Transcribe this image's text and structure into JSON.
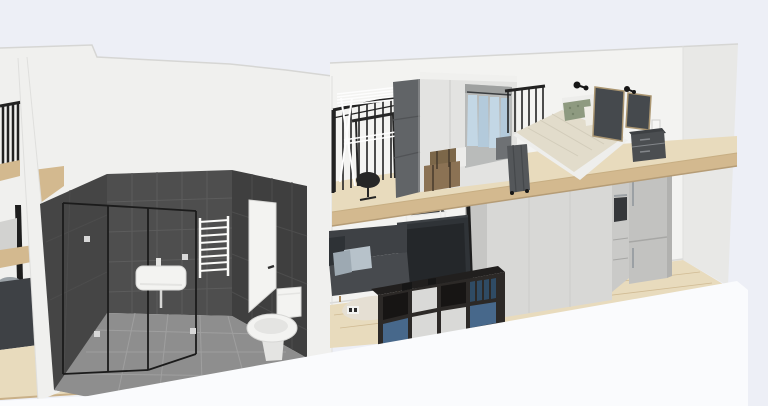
{
  "app": {
    "name": "3d-home-design-viewport",
    "view_mode": "3d-perspective-cutaway",
    "visible_text": ""
  },
  "scene": {
    "units": [
      {
        "name": "neighbor-unit-sliver",
        "objects": [
          "mezzanine-railing",
          "floor-slab",
          "support-post",
          "cabinet",
          "gray-chair",
          "dark-sofa",
          "wood-floor"
        ]
      },
      {
        "name": "main-unit",
        "rooms": [
          {
            "name": "bathroom",
            "objects": [
              "dark-tile-walls",
              "tile-floor",
              "glass-shower-enclosure",
              "wall-mounted-sink",
              "towel-radiator",
              "interior-door",
              "toilet"
            ]
          },
          {
            "name": "living-area",
            "objects": [
              "sofa",
              "throw-pillows",
              "tv",
              "white-side-table",
              "cube-storage-shelf",
              "storage-boxes",
              "round-rug",
              "wall-outlet",
              "three-door-wardrobe",
              "oven-column",
              "fridge-freezer",
              "support-post",
              "wood-floor"
            ]
          },
          {
            "name": "mezzanine-bedroom",
            "objects": [
              "black-railing",
              "drying-rack",
              "desk",
              "office-chair",
              "wardrobe-open-door",
              "open-wardrobe-hanging-clothes",
              "brown-storage-boxes",
              "white-stool",
              "suitcase",
              "double-bed",
              "green-pillow",
              "white-pillow",
              "wall-art-frames",
              "wall-lamps",
              "nightstand",
              "light-switch",
              "railing-segment"
            ]
          }
        ]
      }
    ]
  },
  "colors": {
    "background": "#edeff6",
    "exteriorWall": "#f0f0ee",
    "wallFace": "#f3f3f1",
    "wallShade": "#e8e8e6",
    "wallCapLine": "#d6d6d4",
    "edgeLine": "#dfdfdd",
    "baseboard": "#dadad8",
    "tileWest": "#454545",
    "tileBack": "#4e4e4e",
    "tileRight": "#3f3f3f",
    "groutDark": "#5c5c5c",
    "groutRight": "#4d4d4d",
    "tileFloor": "#8e8e8e",
    "groutFloor": "#a2a2a2",
    "showerFrame": "#1b1b1b",
    "glassHandle": "#d8d8d8",
    "fixtureWhite": "#f3f3f1",
    "fixtureStroke": "#d7d7d5",
    "fixtureShade": "#e4e4e2",
    "doorHandle": "#2f2f2f",
    "radiatorWhite": "#fbfbf9",
    "wood": "#e8dbbd",
    "woodFascia": "#d3b98f",
    "woodLine": "#c7ae83",
    "woodShadow": "#b59c76",
    "railBlack": "#222222",
    "rackWhite": "#fdfdfd",
    "deskBlack": "#262626",
    "doorOpenGray": "#616467",
    "doorSeam": "#515356",
    "wardrobeWhite": "#e3e3e1",
    "wardrobeTop": "#f0f0ee",
    "wardrobeSeam": "#cfcfcd",
    "openingInner": "#b9bbba",
    "openingShadow": "#9fa1a0",
    "clothesA": "#c3d7e5",
    "clothesB": "#b3cadb",
    "clothesRail": "#3a3d40",
    "darkItem": "#6e7174",
    "boxBrown": "#8b7254",
    "boxBrownDark": "#7c6749",
    "strap": "#463b2d",
    "stoolWhite": "#ececea",
    "suitcase": "#54575a",
    "suitcaseLine": "#45484b",
    "bedBase": "#eeeeec",
    "duvet": "#e2dccb",
    "duvetLine": "#d2ccba",
    "headboard": "#ededeb",
    "pillowGreen": "#8e9a80",
    "pillowGreenDot": "#76836a",
    "pillowWhite": "#efede6",
    "frameArt": "#45494d",
    "frameEdge": "#ab9671",
    "lampBlack": "#161616",
    "nightstand": "#4b4e51",
    "nightstandTop": "#3d4043",
    "nightstandLine": "#83868a",
    "switchWhite": "#f6f6f4",
    "sofa": "#3e4145",
    "sofaFront": "#474a4e",
    "sofaDarkPillow": "#2e3236",
    "pillowLight": "#b7c2ca",
    "pillowMid": "#9da9b2",
    "legWood": "#a98a5f",
    "tv": "#2f3337",
    "tvScreen": "#24272a",
    "tvFrame": "#3c4044",
    "tableTop": "#393c3f",
    "tableWhite": "#ebebe9",
    "kallaxTop": "#211f1e",
    "kallaxFront": "#2c2927",
    "kallaxOpen": "#171514",
    "boxBlue": "#47688b",
    "boxWhiteK": "#d9d9d7",
    "boxTeal": "#2f4b64",
    "wardrobeLowFront": "#d8d8d6",
    "wardrobeLowSide": "#c6c6c4",
    "wardrobeLowTop": "#efefed",
    "ovenBody": "#cacac8",
    "ovenWindow": "#35373a",
    "steel": "#9ba0a4",
    "fridgeFront": "#c2c2c0",
    "fridgeSide": "#b1b1af",
    "applianceLine": "#a7a7a5",
    "foreground": "#fafbfd",
    "rug": "#e5dfd3",
    "outletWhite": "#f2f2f0",
    "outletDark": "#2b2b2b",
    "neighborCabinet": "#d2d2d0",
    "chairGray": "#9ba2a7",
    "chairGrayDark": "#70777c",
    "floorEdge": "#c9b088",
    "post": "#1e1e1e"
  }
}
